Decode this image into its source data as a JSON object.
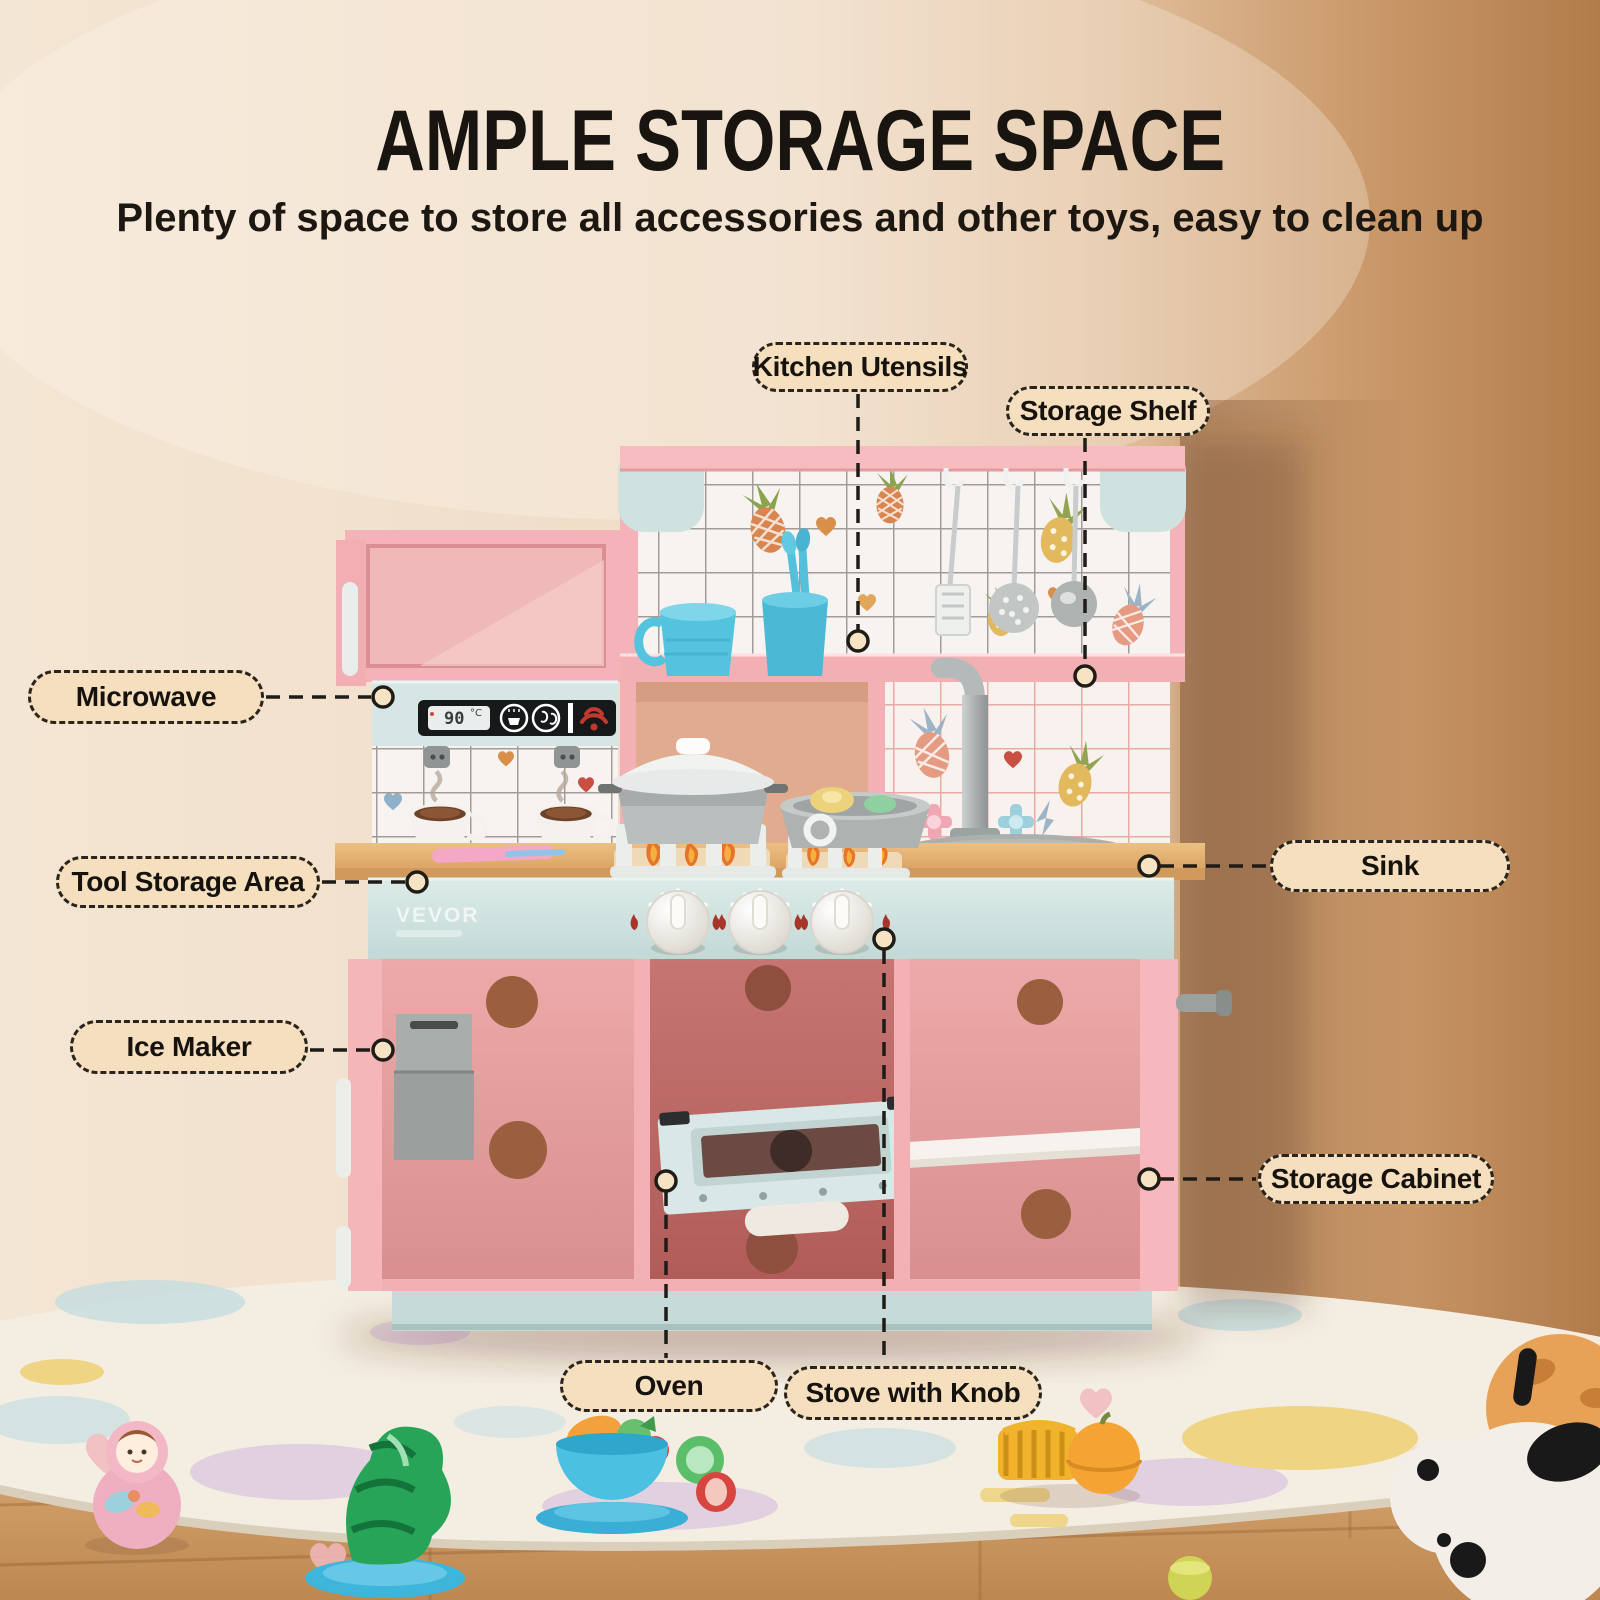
{
  "header": {
    "title": "AMPLE STORAGE SPACE",
    "subtitle": "Plenty of space to store all accessories and other toys, easy to clean up"
  },
  "callouts": [
    {
      "id": "kitchen-utensils",
      "label": "Kitchen Utensils"
    },
    {
      "id": "storage-shelf",
      "label": "Storage Shelf"
    },
    {
      "id": "microwave",
      "label": "Microwave"
    },
    {
      "id": "tool-storage-area",
      "label": "Tool Storage Area"
    },
    {
      "id": "sink",
      "label": "Sink"
    },
    {
      "id": "ice-maker",
      "label": "Ice Maker"
    },
    {
      "id": "storage-cabinet",
      "label": "Storage Cabinet"
    },
    {
      "id": "oven",
      "label": "Oven"
    },
    {
      "id": "stove-with-knob",
      "label": "Stove with Knob"
    }
  ],
  "product": {
    "brand": "VEVOR",
    "microwave_temp": "90",
    "microwave_temp_unit": "°C",
    "microwave_icons": [
      "steam-cup-icon",
      "water-drops-icon",
      "heating-icon"
    ]
  },
  "colors": {
    "wall": "#eedbc5",
    "wall_shadow": "#b27b4a",
    "kitchen_pink": "#f4b3b8",
    "kitchen_mint": "#d4e5e3",
    "counter_wood": "#e2b178",
    "cabinet_interior": "#c4706d",
    "label_bg": "#f5dfbe",
    "label_border": "#2a241e",
    "title_text": "#181410",
    "rug": "#f4eee2",
    "floor": "#d8a873",
    "toy_blue": "#4cc0e0"
  }
}
